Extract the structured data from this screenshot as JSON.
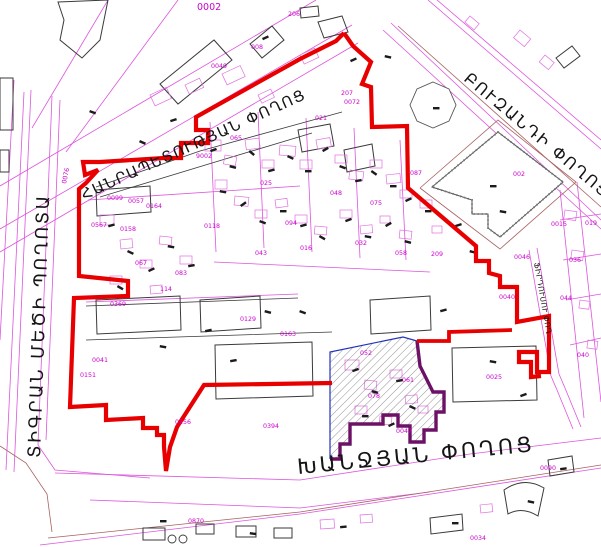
{
  "map": {
    "width": 601,
    "height": 547,
    "background": "#ffffff"
  },
  "colors": {
    "red": "#e80000",
    "magenta": "#dd55dd",
    "parcel": "#e070e0",
    "label": "#cc00cc",
    "black": "#3a3a3a",
    "brown": "#a86060",
    "blue": "#2233bb",
    "purple": "#6d1166",
    "hatch": "#4a4a4a"
  },
  "street_names": [
    {
      "id": "hanrapetutyan",
      "text": "ՀԱՆՐԱՊԵՏՈՒԹՅԱՆ ՓՈՂՈՑ",
      "x": 84,
      "y": 200,
      "rotate": -24.5,
      "size": 15,
      "spacing": 1.5
    },
    {
      "id": "buzand",
      "text": "ԲՈՒԶԱՆԴԻ ՓՈՂՈՑ",
      "x": 463,
      "y": 80,
      "rotate": 40,
      "size": 16,
      "spacing": 2
    },
    {
      "id": "tigran-mets",
      "text": "ՏԻԳՐԱՆ ՄԵԾԻ ՊՈՂՈՏԱ",
      "x": 40,
      "y": 458,
      "rotate": -88,
      "size": 17.5,
      "spacing": 2.5
    },
    {
      "id": "khanjyan",
      "text": "ԽԱՆՋՅԱՆ ՓՈՂՈՑ",
      "x": 298,
      "y": 474,
      "rotate": -5.5,
      "size": 21,
      "spacing": 3
    },
    {
      "id": "firdusi",
      "text": "ՖԻՐԴՈՒՍՈՒ ՓՈՂ",
      "x": 534,
      "y": 263,
      "rotate": 80,
      "size": 7.5,
      "spacing": 0.5
    }
  ],
  "boundary": {
    "west": "344,33 336,41 300,59 196,117 196,130 208,130 208,143 181,143 181,158 164,158 100,162 83,162 85,175 98,170 86,183 79,189 79,276 128,281 128,296 74,298 70,407 106,405 106,420 143,418 143,428 157,428 157,435 164,435 164,447 166,471 170,447 177,427 204,385 332,383",
    "east": "344,33 353,46 371,62 362,84 371,87 372,127 407,126 408,188 476,246 476,261 489,261 489,273 500,276 500,287 517,287 517,322 549,316 549,372 537,372 537,352 519,352 519,362 531,362 531,377 541,376",
    "link": "417,341 449,341 449,332 512,330"
  },
  "hatch_area": {
    "fill": "330,352 403,337 417,341 420,366 433,392 444,392 444,412 436,412 436,430 424,430 424,442 410,442 410,426 398,426 398,415 383,415 383,424 350,424 350,444 340,444 340,459 330,459",
    "blue": "330,459 330,352 403,337 417,341",
    "purple": "417,341 420,366 433,392 444,392 444,412 436,412 436,430 424,430 424,442 410,442 410,426 398,426 398,415 383,415 383,424 350,424 350,444 340,444 340,459 330,459"
  },
  "magenta_lines": [
    "0,229 352,25",
    "0,252 358,43",
    "0,186 316,0",
    "24,92 6,470",
    "31,90 14,472",
    "52,96 38,445 55,470 150,478",
    "60,100 46,440",
    "14,80 0,340",
    "383,30 601,229",
    "391,23 601,220",
    "428,0 601,149",
    "437,0 601,140",
    "55,473 300,480 470,454 601,438",
    "40,545 300,514 601,468",
    "529,250 551,376 557,390 573,429",
    "537,248 559,374 565,388 581,427",
    "32,128 108,0",
    "66,152 178,0",
    "560,190 584,418",
    "577,182 601,402",
    "88,200 300,186",
    "210,122 216,252",
    "258,112 264,248",
    "306,118 312,252",
    "354,128 360,258",
    "400,140 406,260",
    "214,262 430,272",
    "86,302 298,294",
    "560,220 601,214",
    "563,260 601,254",
    "566,300 601,294",
    "570,345 601,338",
    "90,500 300,508 430,492"
  ],
  "brown_lines": [
    "398,26 601,207",
    "48,538 300,512 601,465",
    "420,188 498,120 576,182 500,249 420,188",
    "0,446 26,463 47,494 52,532"
  ],
  "black_lines": [
    "96,187 200,151 302,123 342,112",
    "100,197 212,163 312,133",
    "86,306 298,298",
    "86,340 300,333 332,332"
  ],
  "buildings": [
    "58,2 108,0 100,40 82,58 60,40 64,20",
    "160,84 214,40 232,60 178,104",
    "250,44 272,26 284,40 262,58",
    "318,22 342,16 348,32 324,38",
    "0,78 13,78 13,130 0,130",
    "0,150 9,150 9,172 0,172",
    "215,345 312,342 313,396 216,399",
    "452,348 536,346 537,400 453,402",
    "96,190 150,186 151,212 97,216",
    "96,300 180,296 181,330 97,334",
    "200,300 260,296 261,328 201,332",
    "143,528 165,528 165,540 143,540",
    "196,524 214,524 214,534 196,534",
    "236,526 256,526 256,537 236,537",
    "274,528 292,528 292,538 274,538",
    "430,518 462,514 463,530 431,534",
    "548,460 572,456 574,472 550,476",
    "556,58 572,46 580,56 564,68",
    "300,8 318,6 319,16 301,18",
    "370,300 430,296 431,330 371,334",
    "298,130 330,124 334,146 302,152",
    "344,150 372,144 375,166 347,172"
  ],
  "fan_path": "M504,490 Q524,476 544,488 L538,516 Q522,506 508,514 Z",
  "octagon": "433,82 449,89 456,105 449,121 433,128 417,121 410,105 417,89",
  "market": "498,132 563,182 500,237 488,228 488,214 472,214 472,200 432,187",
  "parcel_rects": [
    [
      150,
      95,
      18,
      12,
      -25
    ],
    [
      185,
      85,
      16,
      10,
      -25
    ],
    [
      222,
      74,
      20,
      12,
      -25
    ],
    [
      300,
      55,
      16,
      10,
      -25
    ],
    [
      258,
      95,
      14,
      9,
      -25
    ],
    [
      205,
      140,
      16,
      11,
      0
    ],
    [
      225,
      155,
      12,
      9,
      10
    ],
    [
      245,
      140,
      14,
      10,
      -8
    ],
    [
      262,
      160,
      12,
      8,
      0
    ],
    [
      280,
      145,
      16,
      10,
      5
    ],
    [
      300,
      160,
      12,
      9,
      0
    ],
    [
      316,
      140,
      14,
      9,
      -10
    ],
    [
      335,
      155,
      12,
      8,
      0
    ],
    [
      350,
      170,
      14,
      9,
      8
    ],
    [
      370,
      160,
      12,
      8,
      0
    ],
    [
      386,
      175,
      14,
      9,
      -6
    ],
    [
      400,
      190,
      12,
      8,
      0
    ],
    [
      215,
      180,
      12,
      9,
      0
    ],
    [
      235,
      196,
      14,
      9,
      6
    ],
    [
      255,
      210,
      12,
      8,
      0
    ],
    [
      275,
      200,
      12,
      8,
      -8
    ],
    [
      295,
      215,
      12,
      8,
      0
    ],
    [
      315,
      226,
      12,
      8,
      5
    ],
    [
      340,
      210,
      12,
      8,
      0
    ],
    [
      360,
      226,
      12,
      8,
      -6
    ],
    [
      380,
      216,
      10,
      7,
      0
    ],
    [
      400,
      230,
      12,
      8,
      6
    ],
    [
      420,
      200,
      12,
      8,
      0
    ],
    [
      432,
      226,
      10,
      7,
      0
    ],
    [
      100,
      215,
      14,
      10,
      0
    ],
    [
      120,
      240,
      12,
      9,
      -6
    ],
    [
      140,
      260,
      12,
      8,
      0
    ],
    [
      160,
      236,
      12,
      8,
      6
    ],
    [
      180,
      256,
      12,
      8,
      0
    ],
    [
      110,
      276,
      12,
      8,
      0
    ],
    [
      150,
      286,
      12,
      8,
      -5
    ],
    [
      345,
      360,
      14,
      10,
      0
    ],
    [
      365,
      380,
      12,
      9,
      6
    ],
    [
      390,
      370,
      12,
      8,
      0
    ],
    [
      405,
      396,
      12,
      8,
      -6
    ],
    [
      355,
      406,
      12,
      8,
      0
    ],
    [
      380,
      416,
      12,
      8,
      5
    ],
    [
      418,
      406,
      10,
      7,
      0
    ],
    [
      565,
      210,
      12,
      9,
      8
    ],
    [
      572,
      250,
      12,
      9,
      8
    ],
    [
      580,
      300,
      10,
      8,
      8
    ],
    [
      588,
      340,
      10,
      8,
      8
    ],
    [
      320,
      520,
      14,
      9,
      -4
    ],
    [
      360,
      515,
      12,
      8,
      -4
    ],
    [
      480,
      505,
      12,
      8,
      -6
    ],
    [
      520,
      30,
      14,
      10,
      40
    ],
    [
      545,
      55,
      12,
      9,
      40
    ],
    [
      470,
      16,
      12,
      8,
      40
    ]
  ],
  "marks": [
    [
      210,
      150,
      -20
    ],
    [
      230,
      165,
      15
    ],
    [
      250,
      150,
      40
    ],
    [
      268,
      170,
      -15
    ],
    [
      288,
      155,
      25
    ],
    [
      305,
      170,
      0
    ],
    [
      322,
      150,
      -30
    ],
    [
      340,
      165,
      20
    ],
    [
      355,
      180,
      -10
    ],
    [
      372,
      170,
      35
    ],
    [
      390,
      185,
      0
    ],
    [
      405,
      200,
      -25
    ],
    [
      220,
      190,
      10
    ],
    [
      240,
      205,
      -35
    ],
    [
      260,
      220,
      20
    ],
    [
      280,
      210,
      0
    ],
    [
      300,
      225,
      -15
    ],
    [
      320,
      235,
      30
    ],
    [
      345,
      220,
      -20
    ],
    [
      365,
      235,
      10
    ],
    [
      385,
      225,
      -30
    ],
    [
      405,
      240,
      15
    ],
    [
      425,
      210,
      0
    ],
    [
      108,
      225,
      -15
    ],
    [
      128,
      250,
      25
    ],
    [
      148,
      270,
      -25
    ],
    [
      168,
      245,
      10
    ],
    [
      188,
      265,
      -10
    ],
    [
      118,
      285,
      30
    ],
    [
      352,
      370,
      -20
    ],
    [
      372,
      390,
      15
    ],
    [
      396,
      380,
      -10
    ],
    [
      410,
      405,
      25
    ],
    [
      362,
      415,
      0
    ],
    [
      388,
      425,
      -25
    ],
    [
      160,
      345,
      10
    ],
    [
      230,
      360,
      -10
    ],
    [
      300,
      310,
      20
    ],
    [
      440,
      310,
      -15
    ],
    [
      490,
      360,
      10
    ],
    [
      520,
      395,
      -20
    ],
    [
      490,
      185,
      0
    ],
    [
      433,
      107,
      0
    ],
    [
      265,
      310,
      15
    ],
    [
      205,
      330,
      -12
    ],
    [
      90,
      110,
      20
    ],
    [
      170,
      120,
      -18
    ],
    [
      140,
      140,
      24
    ],
    [
      470,
      250,
      14
    ],
    [
      455,
      225,
      -18
    ],
    [
      500,
      210,
      10
    ],
    [
      350,
      60,
      -24
    ],
    [
      385,
      55,
      12
    ],
    [
      262,
      38,
      -24
    ],
    [
      160,
      520,
      0
    ],
    [
      250,
      532,
      8
    ],
    [
      340,
      526,
      -6
    ],
    [
      452,
      522,
      0
    ],
    [
      560,
      468,
      -8
    ],
    [
      528,
      500,
      12
    ]
  ],
  "parcel_labels": [
    [
      "0002",
      197,
      10,
      0,
      9.5
    ],
    [
      "206",
      288,
      16
    ],
    [
      "008",
      251,
      49
    ],
    [
      "0049",
      211,
      68
    ],
    [
      "9002",
      196,
      158
    ],
    [
      "0072",
      344,
      104
    ],
    [
      "207",
      341,
      95
    ],
    [
      "002",
      513,
      176
    ],
    [
      "0015",
      551,
      226
    ],
    [
      "0046",
      514,
      259
    ],
    [
      "0040",
      499,
      299
    ],
    [
      "0025",
      486,
      379
    ],
    [
      "0047",
      396,
      433
    ],
    [
      "209",
      431,
      256
    ],
    [
      "0076",
      66,
      184,
      -78
    ],
    [
      "0369",
      110,
      306
    ],
    [
      "0041",
      92,
      362
    ],
    [
      "0151",
      80,
      377
    ],
    [
      "0099",
      107,
      200
    ],
    [
      "0057",
      128,
      203
    ],
    [
      "0164",
      146,
      208
    ],
    [
      "0567",
      91,
      227
    ],
    [
      "0158",
      120,
      231
    ],
    [
      "0118",
      204,
      228
    ],
    [
      "0156",
      175,
      424
    ],
    [
      "0394",
      263,
      428
    ],
    [
      "0870",
      188,
      523
    ],
    [
      "040",
      577,
      357
    ],
    [
      "0163",
      280,
      336
    ],
    [
      "0129",
      240,
      321
    ],
    [
      "114",
      160,
      291
    ],
    [
      "016",
      300,
      250
    ],
    [
      "025",
      260,
      185
    ],
    [
      "048",
      330,
      195
    ],
    [
      "075",
      370,
      205
    ],
    [
      "087",
      410,
      175
    ],
    [
      "065",
      230,
      140
    ],
    [
      "094",
      285,
      225
    ],
    [
      "032",
      355,
      245
    ],
    [
      "058",
      395,
      255
    ],
    [
      "021",
      315,
      120
    ],
    [
      "043",
      255,
      255
    ],
    [
      "067",
      135,
      265
    ],
    [
      "083",
      175,
      275
    ],
    [
      "052",
      360,
      355
    ],
    [
      "061",
      402,
      382
    ],
    [
      "078",
      368,
      398
    ],
    [
      "019",
      585,
      225
    ],
    [
      "036",
      569,
      262
    ],
    [
      "0034",
      470,
      540
    ],
    [
      "0090",
      540,
      470
    ],
    [
      "044",
      560,
      300
    ]
  ],
  "circles": [
    [
      172,
      539,
      4
    ],
    [
      183,
      539,
      4
    ]
  ]
}
